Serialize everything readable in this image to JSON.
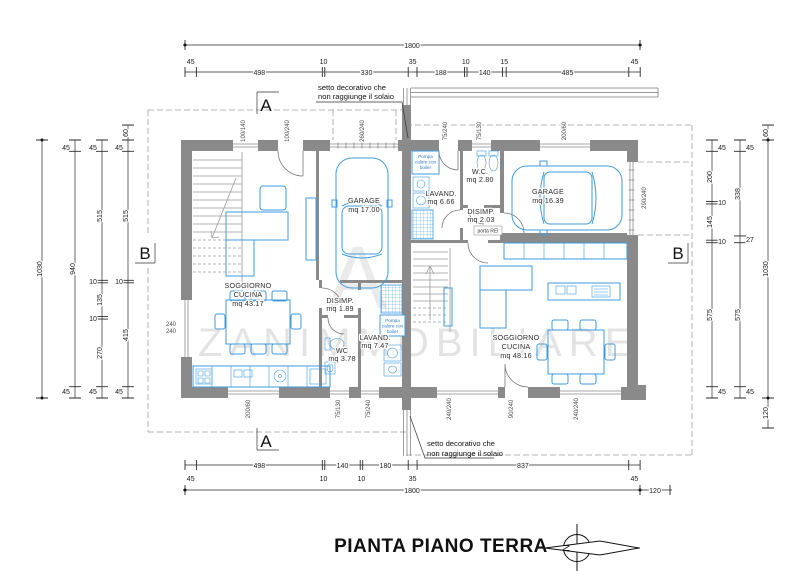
{
  "title": "PIANTA PIANO TERRA",
  "watermark": {
    "text": "ZANIMMOBILIARE",
    "initial": "A"
  },
  "compass": {
    "letter": "N"
  },
  "section_markers": {
    "a": "A",
    "b": "B"
  },
  "annotations": {
    "setto_line1": "setto decorativo che",
    "setto_line2": "non raggiunge il solaio"
  },
  "rooms": {
    "left_unit": {
      "soggiorno": [
        "SOGGIORNO",
        "CUCINA",
        "mq 43.17"
      ],
      "garage": [
        "GARAGE",
        "mq 17.00"
      ],
      "disimp": [
        "DISIMP.",
        "mq 1.89"
      ],
      "wc": [
        "WC",
        "mq 3.78"
      ],
      "lavand": [
        "LAVAND.",
        "mq 7.47"
      ],
      "pompa": [
        "Pompa",
        "calore con",
        "boiler"
      ]
    },
    "right_unit": {
      "lavand": [
        "LAVAND.",
        "mq 6.66"
      ],
      "wc": [
        "W.C.",
        "mq 2.80"
      ],
      "disimp": [
        "DISIMP.",
        "mq 2.03"
      ],
      "garage": [
        "GARAGE",
        "mq 16.39"
      ],
      "soggiorno": [
        "SOGGIORNO",
        "CUCINA",
        "mq 48.16"
      ],
      "pompa": [
        "Pompa",
        "calore con",
        "boiler"
      ],
      "porta_rei": "porta REI"
    }
  },
  "dimensions": {
    "top_total": "1800",
    "top_small": [
      "45",
      "10",
      "35",
      "10",
      "15",
      "45"
    ],
    "top_main": [
      "498",
      "330",
      "188",
      "140",
      "485"
    ],
    "bottom_main": [
      "498",
      "140",
      "180",
      "837"
    ],
    "bottom_small": [
      "45",
      "10",
      "10",
      "35",
      "45"
    ],
    "bottom_total": "1800",
    "bottom_right_ext": "120",
    "left_outer": "1030",
    "left_mid": [
      "45",
      "940",
      "45"
    ],
    "left_inner1": [
      "45",
      "515",
      "10",
      "135",
      "10",
      "270",
      "45"
    ],
    "left_inner2": [
      "60",
      "45",
      "515",
      "10",
      "415",
      "45"
    ],
    "right_inner1": [
      "45",
      "200",
      "10",
      "145",
      "10",
      "575",
      "45"
    ],
    "right_inner2": [
      "45",
      "338",
      "27",
      "575",
      "45"
    ],
    "right_outer": [
      "60",
      "1030",
      "120"
    ]
  },
  "openings": {
    "top": [
      "100/140",
      "100/240",
      "260/240",
      "75/240",
      "75/130",
      "200/60"
    ],
    "bottom": [
      "200/60",
      "75/130",
      "75/240",
      "240/240",
      "90/240",
      "240/240"
    ],
    "left_wall": [
      "240",
      "240"
    ],
    "right_wall": "290/240"
  },
  "colors": {
    "furniture_blue": "#3f9be0",
    "wall_gray": "#8a8a8a"
  }
}
